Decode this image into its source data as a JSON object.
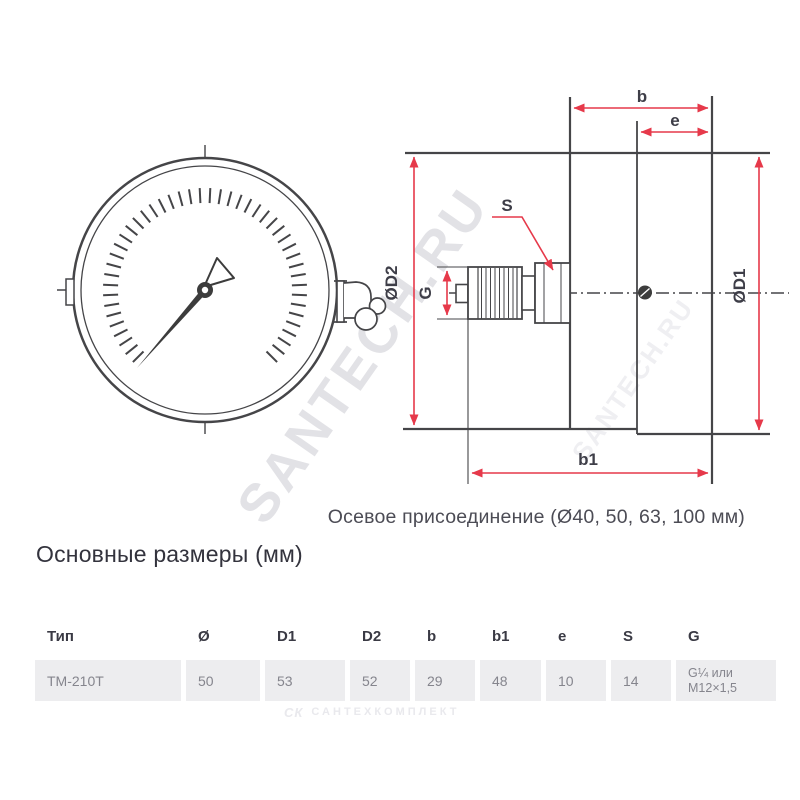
{
  "diagram": {
    "labels": {
      "b": "b",
      "e": "e",
      "b1": "b1",
      "s": "S",
      "g": "G",
      "d1": "ØD1",
      "d2": "ØD2"
    }
  },
  "caption": "Осевое присоединение (Ø40, 50, 63, 100 мм)",
  "section_title": "Основные размеры (мм)",
  "table": {
    "columns": [
      "Тип",
      "Ø",
      "D1",
      "D2",
      "b",
      "b1",
      "e",
      "S",
      "G"
    ],
    "rows": [
      [
        "ТМ-210Т",
        "50",
        "53",
        "52",
        "29",
        "48",
        "10",
        "14",
        "G¼ или M12×1,5"
      ]
    ]
  },
  "watermarks": {
    "diagonal": "SANTECH.RU",
    "bottom_logo": "СК",
    "bottom_text": "САНТЕХКОМПЛЕКТ"
  },
  "colors": {
    "accent_red": "#e6394a",
    "drawing_line": "#454548",
    "label_text": "#3e3e48",
    "cell_background": "#ededef",
    "value_text": "#85858d",
    "header_text": "#3a3a44"
  }
}
